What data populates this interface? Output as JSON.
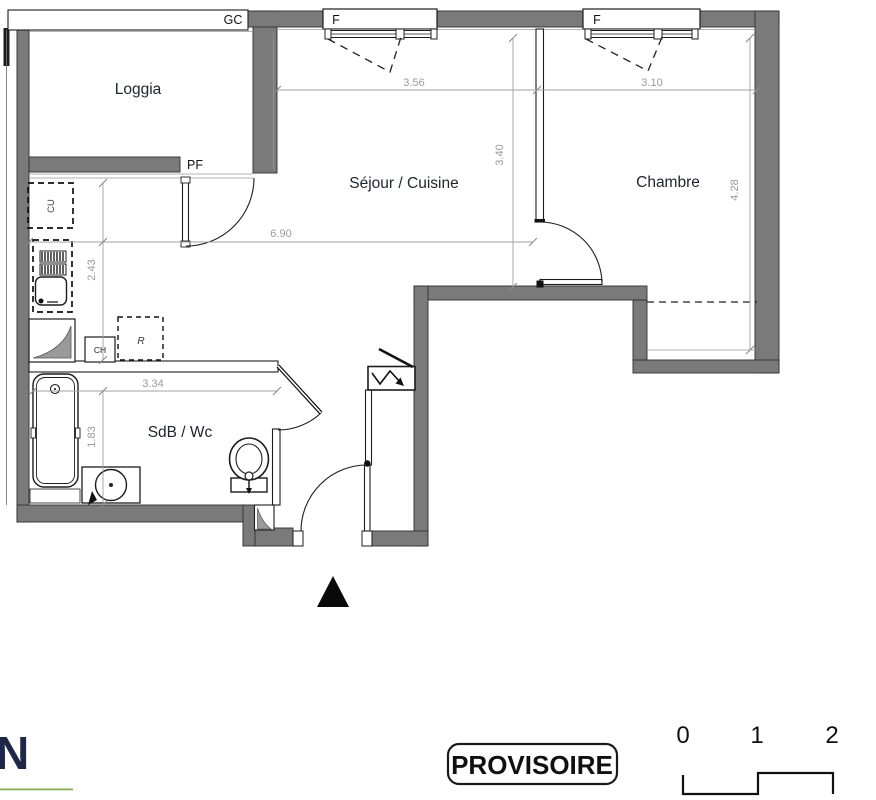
{
  "colors": {
    "wall": "#7a7a7a",
    "dim_text": "#9b9b9b",
    "logo_navy": "#1e2747",
    "logo_green": "#85ab4e"
  },
  "plan": {
    "rooms": {
      "loggia": "Loggia",
      "sejour_cuisine": "Séjour / Cuisine",
      "chambre": "Chambre",
      "sdb_wc": "SdB / Wc"
    },
    "labels": {
      "gc": "GC",
      "pf": "PF",
      "window_sejour": "F",
      "window_chambre": "F",
      "cu": "CU",
      "ch": "CH",
      "refrigerator": "R"
    },
    "dimensions": {
      "sejour_width": "3.56",
      "chambre_width": "3.10",
      "sejour_depth": "3.40",
      "chambre_depth": "4.28",
      "overall_width": "6.90",
      "kitchen_depth": "2.43",
      "sdb_width": "3.34",
      "sdb_depth": "1.83"
    }
  },
  "stamp": {
    "text": "PROVISOIRE"
  },
  "scale_bar": {
    "ticks": [
      "0",
      "1",
      "2"
    ]
  },
  "logo": {
    "letter": "N"
  }
}
